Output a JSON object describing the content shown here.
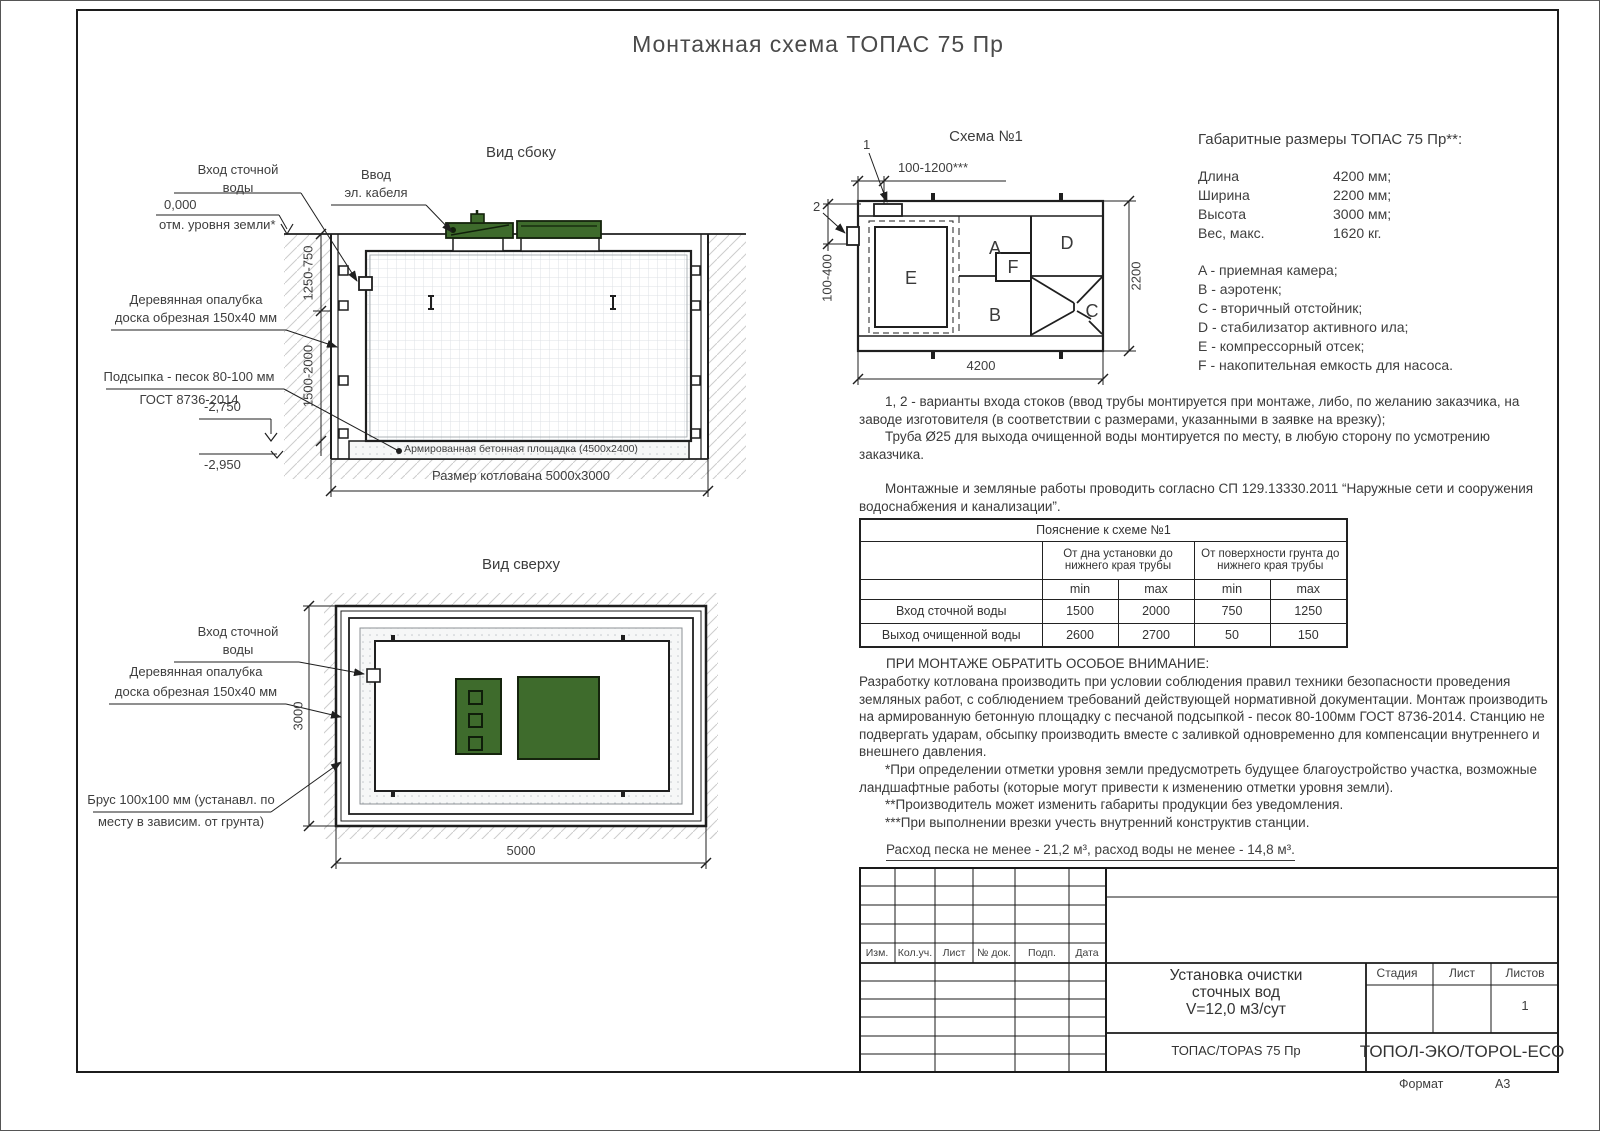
{
  "sheet": {
    "title": "Монтажная схема ТОПАС 75 Пр",
    "format_label": "Формат",
    "format_value": "А3"
  },
  "side_view": {
    "title": "Вид сбоку",
    "inlet_1": "Вход сточной",
    "inlet_2": "воды",
    "zero_mark": "0,000",
    "ground_note": "отм. уровня земли*",
    "cable_1": "Ввод",
    "cable_2": "эл. кабеля",
    "formwork_1": "Деревянная опалубка",
    "formwork_2": "доска обрезная 150х40 мм",
    "sand_1": "Подсыпка - песок 80-100 мм",
    "sand_2": "ГОСТ 8736-2014",
    "elev_pad": "-2,750",
    "elev_bottom": "-2,950",
    "pad_label": "Армированная бетонная площадка (4500х2400)",
    "pit_dim": "Размер котлована 5000х3000",
    "dim_upper": "1250-750",
    "dim_lower": "1500-2000"
  },
  "top_view": {
    "title": "Вид сверху",
    "inlet_1": "Вход сточной",
    "inlet_2": "воды",
    "formwork_1": "Деревянная опалубка",
    "formwork_2": "доска обрезная 150х40 мм",
    "brus_1": "Брус 100х100 мм (устанавл. по",
    "brus_2": "месту в зависим. от грунта)",
    "dim_width": "3000",
    "dim_length": "5000"
  },
  "schema": {
    "title": "Схема №1",
    "callout_1": "1",
    "callout_2": "2",
    "dim_top": "100-1200***",
    "dim_left": "100-400",
    "dim_right": "2200",
    "dim_bottom": "4200",
    "rooms": {
      "A": "A",
      "B": "B",
      "C": "C",
      "D": "D",
      "E": "E",
      "F": "F"
    }
  },
  "overall": {
    "title": "Габаритные размеры ТОПАС 75 Пр**:",
    "rows": [
      {
        "name": "Длина",
        "value": "4200 мм;"
      },
      {
        "name": "Ширина",
        "value": "2200 мм;"
      },
      {
        "name": "Высота",
        "value": "3000 мм;"
      },
      {
        "name": "Вес, макс.",
        "value": "1620 кг."
      }
    ],
    "legend": [
      "A - приемная камера;",
      "B - аэротенк;",
      "C - вторичный отстойник;",
      "D - стабилизатор активного ила;",
      "E - компрессорный отсек;",
      "F - накопительная емкость для насоса."
    ]
  },
  "notes": {
    "p1": "1, 2 - варианты входа  стоков (ввод трубы монтируется при монтаже, либо, по желанию заказчика, на заводе изготовителя (в соответствии с размерами, указанными в заявке на врезку);",
    "p2": "Труба Ø25 для выхода очищенной воды монтируется по месту, в любую сторону по усмотрению заказчика.",
    "p3": "Монтажные и земляные работы проводить согласно СП 129.13330.2011 “Наружные сети и сооружения водоснабжения и канализации”."
  },
  "table": {
    "title": "Пояснение к схеме №1",
    "group1": "От дна установки до нижнего края трубы",
    "group2": "От поверхности грунта до нижнего края трубы",
    "min": "min",
    "max": "max",
    "rows": [
      {
        "name": "Вход сточной воды",
        "v1": "1500",
        "v2": "2000",
        "v3": "750",
        "v4": "1250"
      },
      {
        "name": "Выход очищенной воды",
        "v1": "2600",
        "v2": "2700",
        "v3": "50",
        "v4": "150"
      }
    ]
  },
  "attention": {
    "title": "ПРИ МОНТАЖЕ ОБРАТИТЬ ОСОБОЕ ВНИМАНИЕ:",
    "body": "Разработку котлована производить при условии соблюдения правил техники безопасности проведения земляных работ, с соблюдением требований действующей нормативной документации.  Монтаж производить на армированную бетонную площадку с песчаной подсыпкой - песок 80-100мм ГОСТ 8736-2014. Станцию не подвергать ударам, обсыпку производить вместе с заливкой одновременно для компенсации внутреннего и внешнего давления."
  },
  "footnotes": [
    "*При определении отметки уровня земли предусмотреть будущее благоустройство участка, возможные ландшафтные работы (которые могут привести к изменению отметки уровня земли).",
    "**Производитель может изменить габариты продукции без уведомления.",
    "***При выполнении врезки учесть внутренний конструктив станции."
  ],
  "consumption": "Расход песка не менее - 21,2 м³, расход воды не менее - 14,8 м³.",
  "titleblock": {
    "rev_headers": [
      "Изм.",
      "Кол.уч.",
      "Лист",
      "№ док.",
      "Подп.",
      "Дата"
    ],
    "doc_line1": "Установка очистки",
    "doc_line2": "сточных вод",
    "doc_line3": "V=12,0 м3/сут",
    "stage_label": "Стадия",
    "sheet_label": "Лист",
    "sheets_label": "Листов",
    "sheets_value": "1",
    "model": "ТОПАС/TOPAS 75 Пр",
    "company": "ТОПОЛ-ЭКО/TOPOL-ECO"
  },
  "colors": {
    "green": "#3e6b2c",
    "line": "#1f1f1f"
  }
}
